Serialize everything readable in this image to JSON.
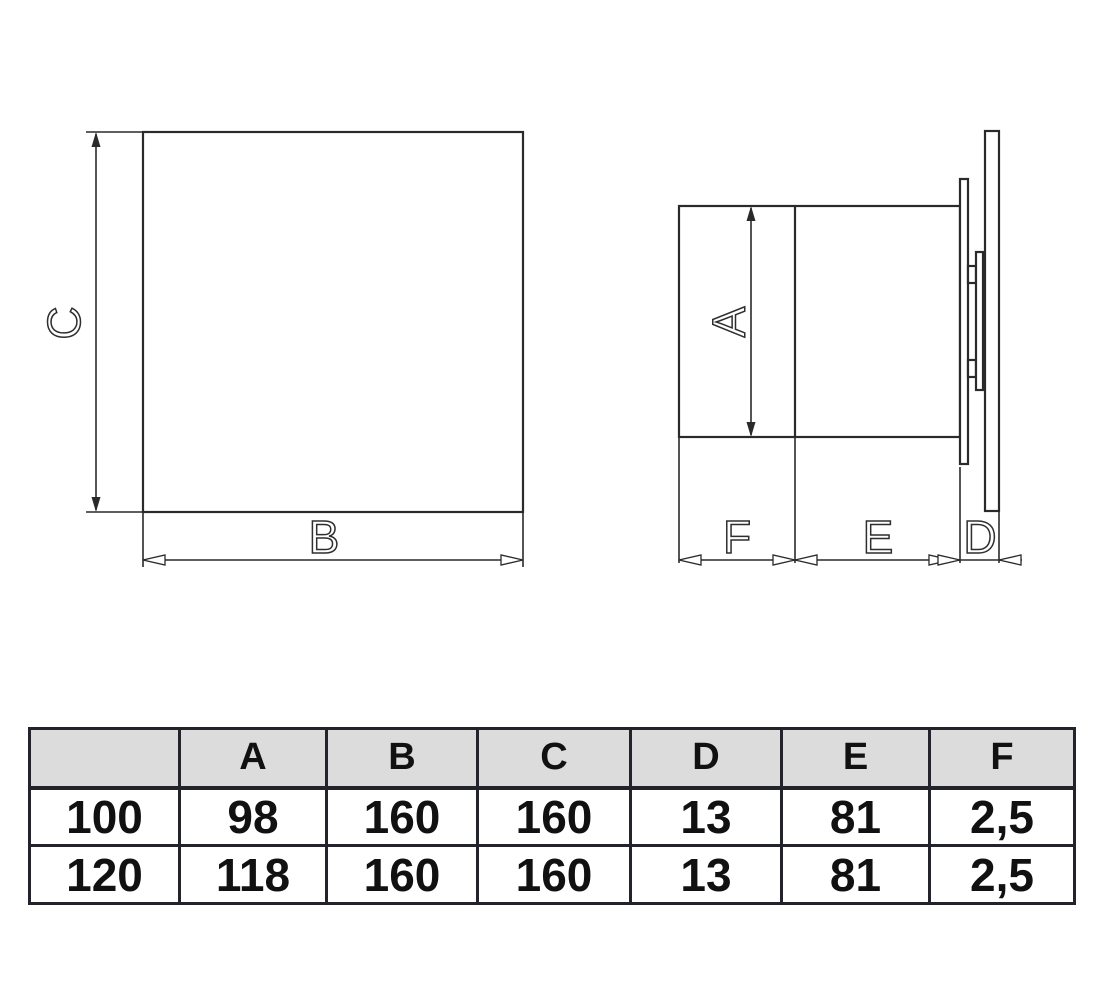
{
  "colors": {
    "background": "#ffffff",
    "line": "#2a2a2a",
    "table_border": "#23232b",
    "table_header_bg": "#dcdcdc",
    "text": "#111111"
  },
  "diagram": {
    "labels": {
      "a": "A",
      "b": "B",
      "c": "C",
      "d": "D",
      "e": "E",
      "f": "F"
    }
  },
  "table": {
    "headers": [
      "",
      "A",
      "B",
      "C",
      "D",
      "E",
      "F"
    ],
    "rows": [
      [
        "100",
        "98",
        "160",
        "160",
        "13",
        "81",
        "2,5"
      ],
      [
        "120",
        "118",
        "160",
        "160",
        "13",
        "81",
        "2,5"
      ]
    ]
  }
}
